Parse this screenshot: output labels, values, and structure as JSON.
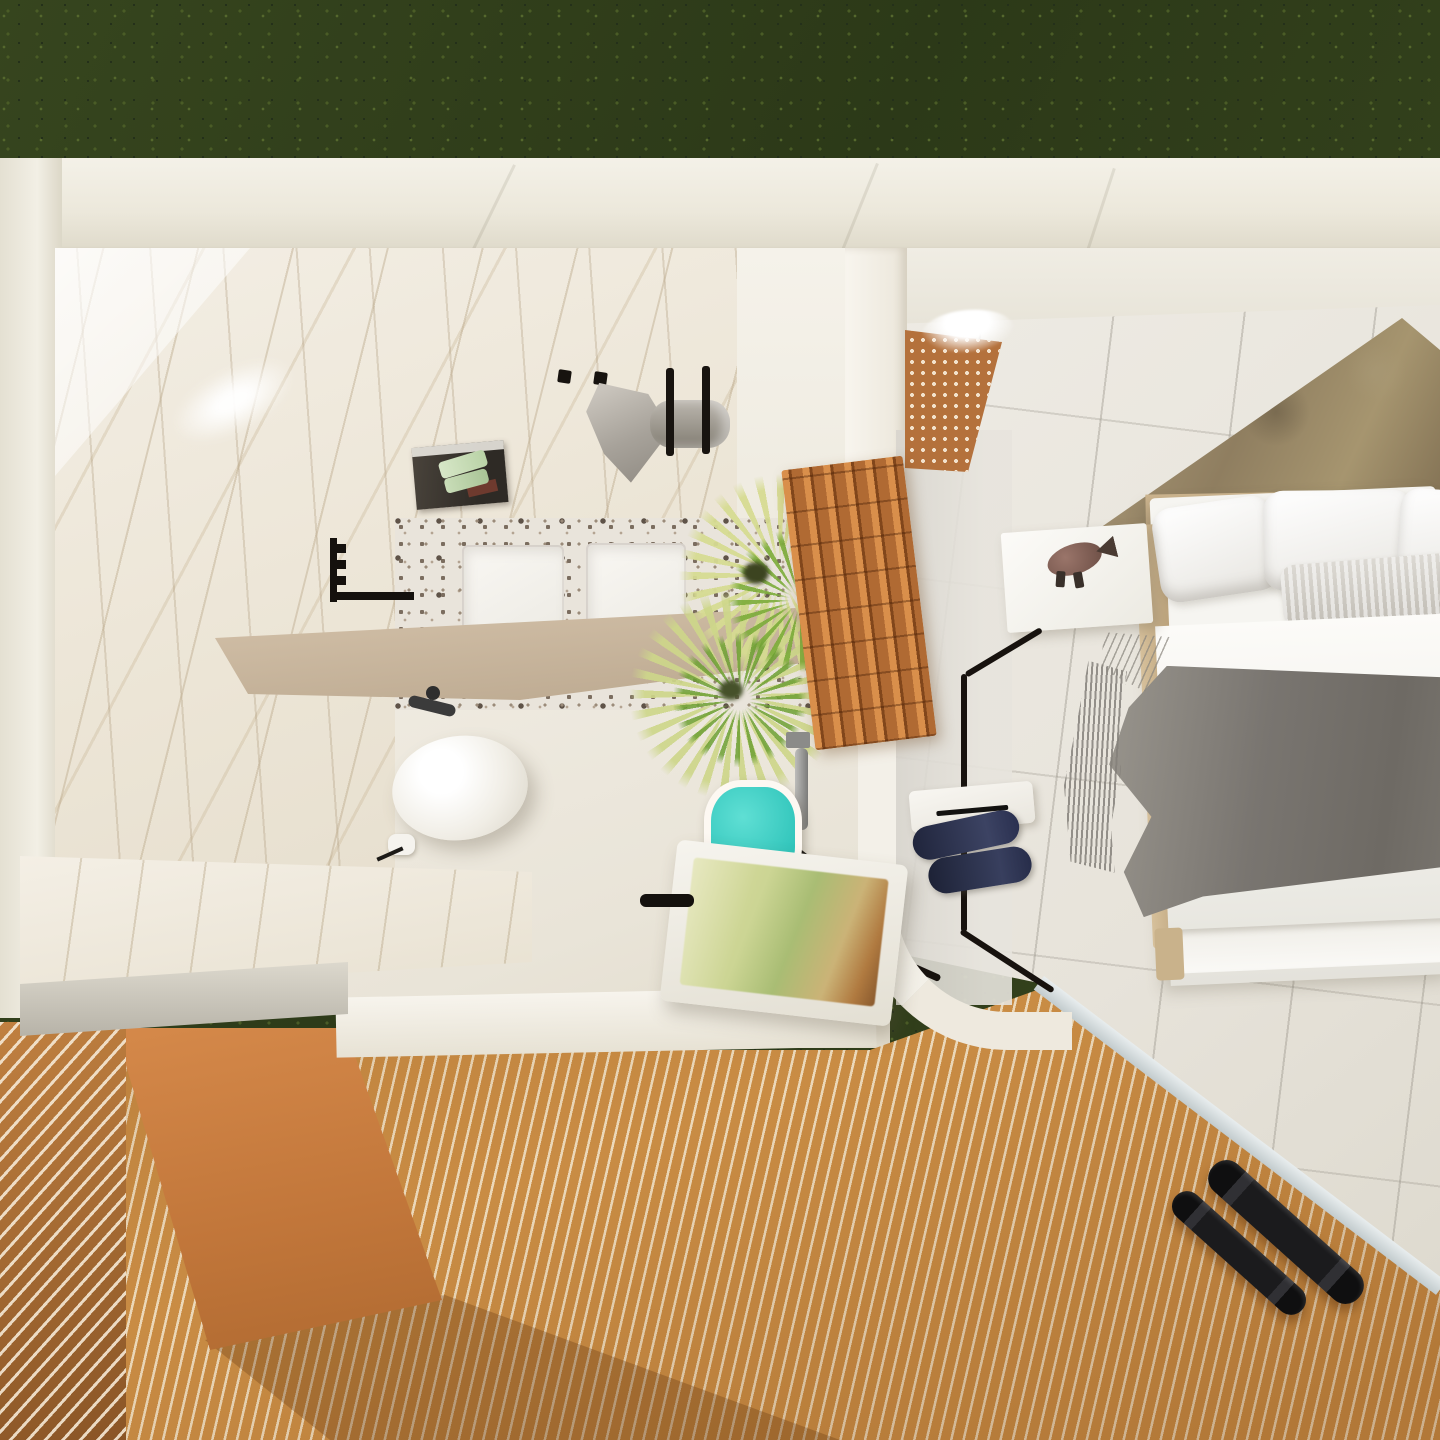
{
  "scene": {
    "description": "Top-down 3D architectural render of a hotel-style suite: marble bathroom with walk-in shower, freestanding tub and vessel sink on the left, bedroom with double bed on the right, terracotta slatted screens and a wooden deck terrace below, surrounded by a grass lawn.",
    "view": "overhead dollhouse / floor-plan render",
    "rooms": [
      "garden lawn",
      "bathroom",
      "bedroom",
      "deck terrace"
    ],
    "objects": [
      {
        "name": "grass-lawn",
        "label": "Grass lawn"
      },
      {
        "name": "outer-wall",
        "label": "White outer wall"
      },
      {
        "name": "marble-wall-floor",
        "label": "Calacatta marble wall/floor slab"
      },
      {
        "name": "shower-terrazzo-floor",
        "label": "Terrazzo shower floor"
      },
      {
        "name": "shower-tray",
        "label": "White shower tray"
      },
      {
        "name": "storage-niche",
        "label": "Wall niche with green towels"
      },
      {
        "name": "hanging-towel",
        "label": "Gray towel on hook"
      },
      {
        "name": "rolled-towel",
        "label": "Rolled gray towel on rail"
      },
      {
        "name": "wall-hanger",
        "label": "Black wall-mounted hanger"
      },
      {
        "name": "floating-shelf",
        "label": "Beige floating shelf"
      },
      {
        "name": "vessel-sink",
        "label": "Oval white vessel sink"
      },
      {
        "name": "sink-faucet",
        "label": "Dark wall faucet"
      },
      {
        "name": "toilet-paper-holder",
        "label": "Toilet paper holder"
      },
      {
        "name": "vanity-bench",
        "label": "Marble vanity bench"
      },
      {
        "name": "palm-plant",
        "label": "Potted palm plant"
      },
      {
        "name": "slatted-divider",
        "label": "Terracotta slatted divider screen"
      },
      {
        "name": "glass-door-handle",
        "label": "Glass door handle"
      },
      {
        "name": "teal-stool",
        "label": "Teal stool"
      },
      {
        "name": "bathtub",
        "label": "Freestanding bathtub with water"
      },
      {
        "name": "grab-bar",
        "label": "Black grab bar"
      },
      {
        "name": "cobogo-wall",
        "label": "Perforated clay cobogó wall with LED cove"
      },
      {
        "name": "stone-accent-wall",
        "label": "Stone accent wall behind bed"
      },
      {
        "name": "bed",
        "label": "Double bed with white bedding and gray throw"
      },
      {
        "name": "nightstand",
        "label": "White nightstand"
      },
      {
        "name": "fish-sculpture",
        "label": "Fish figurine decor"
      },
      {
        "name": "floor-lamp",
        "label": "Black bent-rod floor lamp"
      },
      {
        "name": "bench-tray",
        "label": "White bedside bench"
      },
      {
        "name": "slippers",
        "label": "Navy slippers"
      },
      {
        "name": "wood-deck",
        "label": "Wood slat deck"
      },
      {
        "name": "slatted-screen",
        "label": "Orange slatted privacy screen"
      },
      {
        "name": "orange-wall",
        "label": "Terracotta wall"
      },
      {
        "name": "dumbbells",
        "label": "Pair of black dumbbells"
      }
    ],
    "palette": {
      "grass": "#313f1b",
      "outer_wall": "#f2efe5",
      "marble": "#ece5d6",
      "marble_vein": "#bcaa8c",
      "terrazzo_base": "#e9e4db",
      "terrazzo_speck": "#74675c",
      "shelf_beige": "#c6b294",
      "towel_gray": "#a7a29a",
      "niche_towel_green": "#c4d9af",
      "plant_light": "#d6db92",
      "plant_green": "#7cac3a",
      "divider_terracotta": "#b06a33",
      "teal_stool": "#2fc4ba",
      "tub_water_olive": "#b3c27c",
      "bedroom_tile": "#e9e5dd",
      "stone_wall": "#978564",
      "headboard_tan": "#c4ac85",
      "bed_white": "#f6f5f1",
      "throw_gray": "#79756f",
      "slipper_navy": "#2b3150",
      "lamp_black": "#17120e",
      "cobogo_clay": "#b4713c",
      "led_white": "#ffffff",
      "deck_slat": "#c98c44",
      "deck_gap": "#ecd9ba",
      "screen_orange": "#c08040",
      "wall_orange": "#c1763a",
      "dumbbell_black": "#1b1b1d",
      "deck_edge_trim": "#d5dcde"
    }
  }
}
